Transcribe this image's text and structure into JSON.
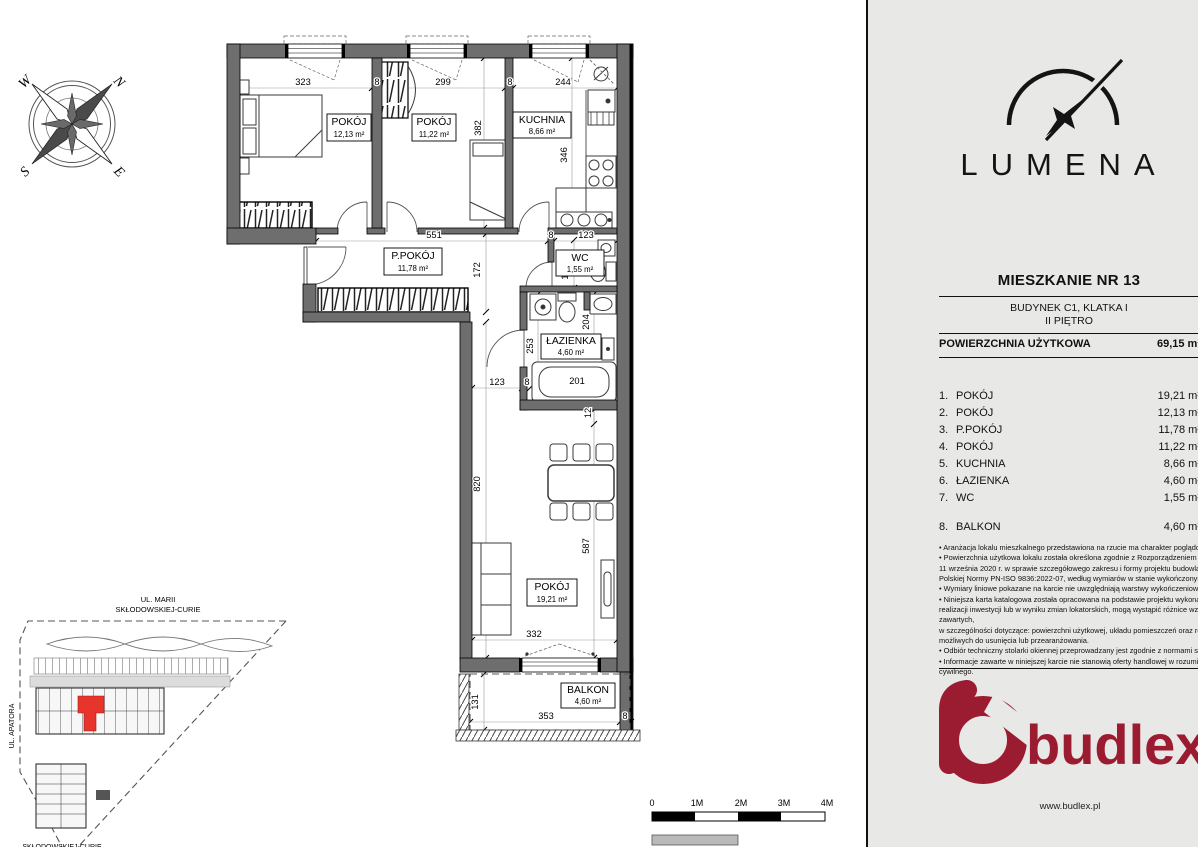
{
  "panel": {
    "brand": "LUMENA",
    "title": "MIESZKANIE NR 13",
    "subtitle1": "BUDYNEK C1, KLATKA I",
    "subtitle2": "II PIĘTRO",
    "area_label": "POWIERZCHNIA UŻYTKOWA",
    "area_value": "69,15 m²",
    "rooms": [
      {
        "no": "1.",
        "name": "POKÓJ",
        "area": "19,21 m²"
      },
      {
        "no": "2.",
        "name": "POKÓJ",
        "area": "12,13 m²"
      },
      {
        "no": "3.",
        "name": "P.POKÓJ",
        "area": "11,78 m²"
      },
      {
        "no": "4.",
        "name": "POKÓJ",
        "area": "11,22 m²"
      },
      {
        "no": "5.",
        "name": "KUCHNIA",
        "area": "8,66 m²"
      },
      {
        "no": "6.",
        "name": "ŁAZIENKA",
        "area": "4,60 m²"
      },
      {
        "no": "7.",
        "name": "WC",
        "area": "1,55 m²"
      }
    ],
    "balcony_row": {
      "no": "8.",
      "name": "BALKON",
      "area": "4,60 m²"
    },
    "disclaimer": [
      "• Aranżacja lokalu mieszkalnego przedstawiona na rzucie ma charakter poglądowy.",
      "• Powierzchnia użytkowa lokalu została określona zgodnie z Rozporządzeniem Ministra Rozw",
      "11 września 2020 r. w sprawie szczegółowego zakresu i formy projektu budowlanego oraz na p",
      "Polskiej Normy PN-ISO 9836:2022-07, według wymiarów w stanie wykończonym na poziomie p",
      "• Wymiary liniowe pokazane na karcie nie uwzględniają warstwy wykończeniowej ścian, takiej",
      "• Niniejsza karta katalogowa została opracowana na podstawie projektu wykonawczego. Na e",
      "realizacji inwestycji lub w wyniku zmian lokatorskich, mogą wystąpić różnice względem informa",
      "zawartych,",
      "w szczególności dotyczące: powierzchni użytkowej, układu pomieszczeń oraz rozmieszczenia",
      "możliwych do usunięcia lub przearanżowania.",
      "• Odbiór techniczny stolarki okiennej przeprowadzany jest zgodnie z normami serii PN-EN 127",
      "• Informacje zawarte w niniejszej karcie nie stanowią oferty handlowej w rozumieniu art. 66 Ko",
      "cywilnego."
    ],
    "footer_brand": "budlex",
    "footer_url": "www.budlex.pl"
  },
  "plan": {
    "labels": {
      "pokoj2": {
        "name": "POKÓJ",
        "area": "12,13 m²"
      },
      "pokoj4": {
        "name": "POKÓJ",
        "area": "11,22 m²"
      },
      "kuchnia": {
        "name": "KUCHNIA",
        "area": "8,66 m²"
      },
      "ppokoj": {
        "name": "P.POKÓJ",
        "area": "11,78 m²"
      },
      "wc": {
        "name": "WC",
        "area": "1,55 m²"
      },
      "lazienka": {
        "name": "ŁAZIENKA",
        "area": "4,60 m²"
      },
      "pokoj1": {
        "name": "POKÓJ",
        "area": "19,21 m²"
      },
      "balkon": {
        "name": "BALKON",
        "area": "4,60 m²"
      }
    },
    "dims": {
      "t323": "323",
      "t8a": "8",
      "t299": "299",
      "t8b": "8",
      "t244": "244",
      "v382": "382",
      "v346": "346",
      "t551": "551",
      "t8c": "8",
      "t123a": "123",
      "v172": "172",
      "v132": "132",
      "v253": "253",
      "v204": "204",
      "t123b": "123",
      "t8d": "8",
      "t201": "201",
      "v12": "12",
      "v820": "820",
      "v587": "587",
      "t332": "332",
      "v131": "131",
      "t353": "353",
      "t8e": "8"
    }
  },
  "compass": {
    "n": "N",
    "e": "E",
    "s": "S",
    "w": "W"
  },
  "site": {
    "street_top_l1": "UL. MARII",
    "street_top_l2": "SKŁODOWSKIEJ-CURIE",
    "street_left": "UL. APATORA",
    "street_bottom": "SKŁODOWSKIEJ-CURIE"
  },
  "scalebar": {
    "l0": "0",
    "l1": "1M",
    "l2": "2M",
    "l3": "3M",
    "l4": "4M"
  },
  "colors": {
    "brand_red": "#9b1b30",
    "highlight_red": "#e8352b",
    "wall_gray": "#6e6e6e",
    "panel_bg": "#e8e8e7"
  }
}
